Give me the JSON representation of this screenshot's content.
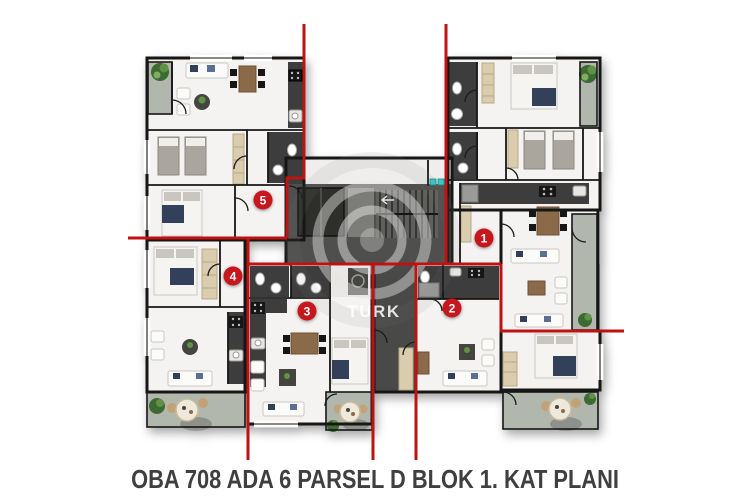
{
  "title": "OBA 708 ADA 6 PARSEL D BLOK 1. KAT PLANI",
  "watermark": "TURK",
  "units": [
    {
      "number": "1",
      "x": 484,
      "y": 238
    },
    {
      "number": "2",
      "x": 452,
      "y": 308
    },
    {
      "number": "3",
      "x": 307,
      "y": 311
    },
    {
      "number": "4",
      "x": 233,
      "y": 276
    },
    {
      "number": "5",
      "x": 263,
      "y": 200
    }
  ],
  "colors": {
    "unit_line_red": "#bf1212",
    "marker_red": "#c8161d",
    "core_gray": "#4f4f4d",
    "dark_room": "#3e3e3c",
    "balcony_gray": "#b2b7ae",
    "tree_green": "#3c6a31",
    "teal_fixture": "#3ec8c8",
    "navy_accent": "#31415a",
    "wood_brown": "#8a6a48",
    "title_text": "#3f3f3f"
  }
}
